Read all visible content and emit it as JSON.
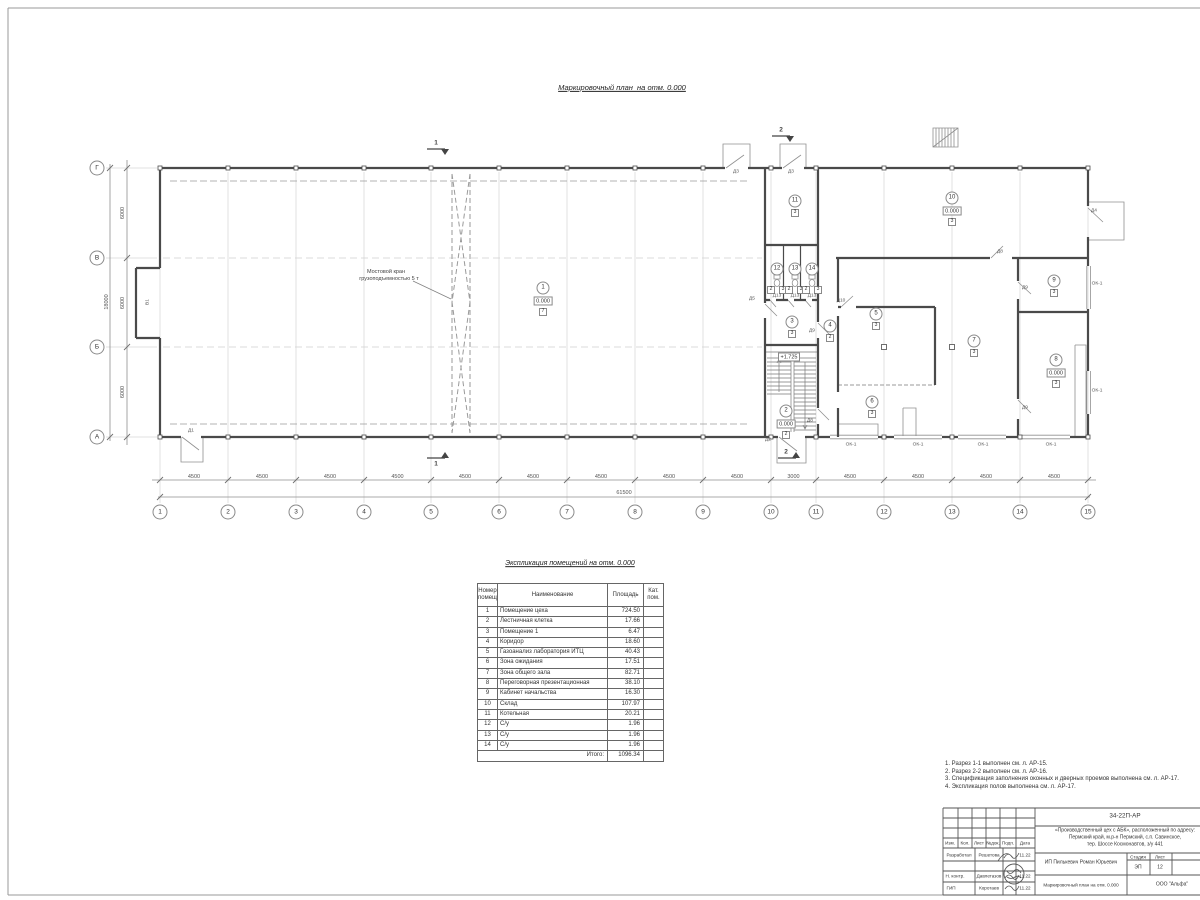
{
  "page": {
    "plan_title": "Маркировочный план  на отм. 0.000"
  },
  "plan": {
    "grid_cols": [
      "1",
      "2",
      "3",
      "4",
      "5",
      "6",
      "7",
      "8",
      "9",
      "10",
      "11",
      "12",
      "13",
      "14",
      "15"
    ],
    "grid_rows": [
      "Г",
      "В",
      "Б",
      "А"
    ],
    "dims_bottom": [
      "4500",
      "4500",
      "4500",
      "4500",
      "4500",
      "4500",
      "4500",
      "4500",
      "4500",
      "3000",
      "4500",
      "4500",
      "4500",
      "4500"
    ],
    "dim_total_bottom": "61500",
    "dims_left": [
      "6000",
      "6000",
      "6000"
    ],
    "dim_total_left": "18000",
    "gate_label": "В1",
    "crane_label_line1": "Мостовой кран",
    "crane_label_line2": "грузоподъемностью 5 т",
    "stair_elevation": "+1.725",
    "sections": {
      "s1": "1",
      "s2": "2"
    },
    "rooms": [
      {
        "num": "1",
        "elev": "0.000",
        "cat": "7"
      },
      {
        "num": "2",
        "elev": "0.000",
        "cat": "2"
      },
      {
        "num": "3",
        "cat": "3"
      },
      {
        "num": "4",
        "cat": "2"
      },
      {
        "num": "5",
        "cat": "3"
      },
      {
        "num": "6",
        "cat": "3"
      },
      {
        "num": "7",
        "cat": "3"
      },
      {
        "num": "8",
        "elev": "0.000",
        "cat": "3"
      },
      {
        "num": "9",
        "cat": "3"
      },
      {
        "num": "10",
        "elev": "0.000",
        "cat": "3"
      },
      {
        "num": "11",
        "cat": "3"
      },
      {
        "num": "12"
      },
      {
        "num": "13"
      },
      {
        "num": "14"
      }
    ],
    "stall_boxes": [
      "2",
      "3",
      "2",
      "3",
      "2",
      "3"
    ],
    "door_labels": [
      "Д1",
      "Д2",
      "Д3",
      "Д3",
      "Д4",
      "Д5",
      "Д8",
      "Д8",
      "Д9",
      "Д9",
      "Д9",
      "Д10",
      "Д13",
      "Д13",
      "Д13"
    ],
    "window_labels": [
      "ОК-1",
      "ОК-1",
      "ОК-1",
      "ОК-1",
      "ОК-1",
      "ОК-1"
    ]
  },
  "table": {
    "title": "Экспликация помещений на отм. 0.000",
    "header": {
      "num1": "Номер",
      "num2": "помещ.",
      "name": "Наименование",
      "area": "Площадь",
      "cat1": "Кат.",
      "cat2": "пом."
    },
    "rows": [
      {
        "num": "1",
        "name": "Помещение цеха",
        "area": "724.50",
        "cat": ""
      },
      {
        "num": "2",
        "name": "Лестничная клетка",
        "area": "17.66",
        "cat": ""
      },
      {
        "num": "3",
        "name": "Помещение 1",
        "area": "6.47",
        "cat": ""
      },
      {
        "num": "4",
        "name": "Коридор",
        "area": "18.60",
        "cat": ""
      },
      {
        "num": "5",
        "name": "Газоанализ лаборатория ИТЦ",
        "area": "40.43",
        "cat": ""
      },
      {
        "num": "6",
        "name": "Зона ожидания",
        "area": "17.51",
        "cat": ""
      },
      {
        "num": "7",
        "name": "Зона общего зала",
        "area": "82.71",
        "cat": ""
      },
      {
        "num": "8",
        "name": "Переговорная презентационная",
        "area": "38.10",
        "cat": ""
      },
      {
        "num": "9",
        "name": "Кабинет начальства",
        "area": "16.30",
        "cat": ""
      },
      {
        "num": "10",
        "name": "Склад",
        "area": "107.97",
        "cat": ""
      },
      {
        "num": "11",
        "name": "Котельная",
        "area": "20.21",
        "cat": ""
      },
      {
        "num": "12",
        "name": "С/у",
        "area": "1.96",
        "cat": ""
      },
      {
        "num": "13",
        "name": "С/у",
        "area": "1.96",
        "cat": ""
      },
      {
        "num": "14",
        "name": "С/у",
        "area": "1.96",
        "cat": ""
      }
    ],
    "total_label": "Итого:",
    "total_value": "1096.34"
  },
  "notes": [
    "1. Разрез 1-1 выполнен см. л. АР-15.",
    "2. Разрез 2-2 выполнен см. л. АР-16.",
    "3. Спецификация заполнения оконных и дверных проемов выполнена см. л. АР-17.",
    "4. Экспликация полов выполнена см. л. АР-17."
  ],
  "titleblock": {
    "doc_number": "34-22П-АР",
    "project_line1": "«Производственный цех с АБК», расположенный по адресу:",
    "project_line2": "Пермский край, м.р-н Пермский, с.п. Савинское,",
    "project_line3": "тер. Шоссе Космонавтов, з/у 441",
    "cols": {
      "izm": "Изм.",
      "kol": "Кол.",
      "list": "Лист",
      "ndok": "№док.",
      "podp": "Подп.",
      "data": "Дата"
    },
    "rows": {
      "r1_role": "Разработал",
      "r1_name": "Решетова",
      "r1_date": "11.22",
      "r3_role": "Н. контр.",
      "r3_name": "Давлетазов",
      "r3_date": "11.22",
      "r4_role": "ГИП",
      "r4_name": "Коротаев",
      "r4_date": "11.22"
    },
    "client": "ИП Пилькевич Роман Юрьевич",
    "sheet_title": "Маркировочный план на отм. 0.000",
    "stage_label": "Стадия",
    "stage_value": "ЭП",
    "list_label": "Лист",
    "list_value": "12",
    "org": "ООО \"Альфа\""
  }
}
